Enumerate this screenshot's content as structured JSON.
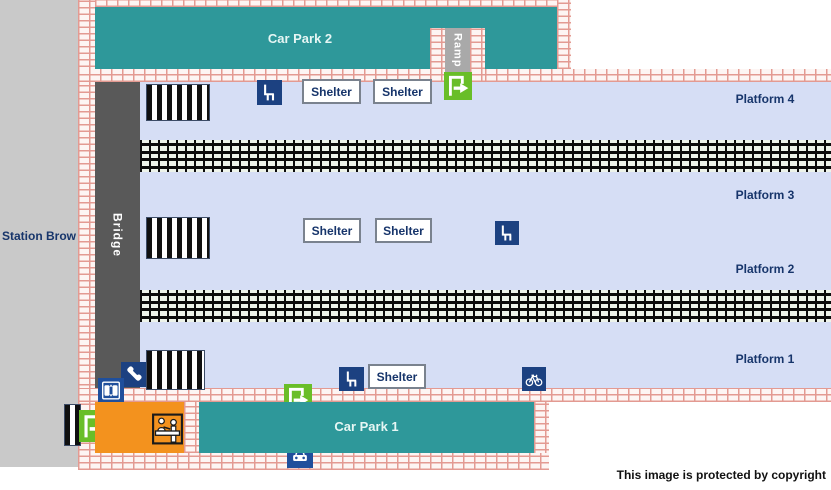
{
  "street": {
    "label": "Station Brow"
  },
  "car_parks": [
    {
      "id": "car-park-2",
      "label": "Car Park 2"
    },
    {
      "id": "car-park-1",
      "label": "Car Park 1"
    }
  ],
  "ramp": {
    "label": "Ramp"
  },
  "bridge": {
    "label": "Bridge"
  },
  "platforms": [
    {
      "label": "Platform 4"
    },
    {
      "label": "Platform 3"
    },
    {
      "label": "Platform 2"
    },
    {
      "label": "Platform 1"
    }
  ],
  "shelters": [
    {
      "location": "platform-4-west",
      "label": "Shelter"
    },
    {
      "location": "platform-4-east",
      "label": "Shelter"
    },
    {
      "location": "island-west",
      "label": "Shelter"
    },
    {
      "location": "island-east",
      "label": "Shelter"
    },
    {
      "location": "platform-1",
      "label": "Shelter"
    }
  ],
  "icons": [
    {
      "name": "seat-icon",
      "meaning": "seating",
      "locations": [
        "platform-4",
        "island-platform",
        "platform-1"
      ]
    },
    {
      "name": "exit-icon",
      "meaning": "entrance/exit",
      "locations": [
        "ramp",
        "car-park-1",
        "street-south-west"
      ]
    },
    {
      "name": "phone-icon",
      "meaning": "telephone"
    },
    {
      "name": "lift-icon",
      "meaning": "lift/doors"
    },
    {
      "name": "bicycle-icon",
      "meaning": "cycle storage"
    },
    {
      "name": "taxi-icon",
      "meaning": "taxi rank"
    },
    {
      "name": "ticket-office-icon",
      "meaning": "ticket office"
    }
  ],
  "colors": {
    "car_park_teal": "#2e989a",
    "platform_lavender": "#d6def5",
    "bridge_gray": "#595959",
    "ramp_gray": "#a9a9a9",
    "brick_pink": "#e39a92",
    "icon_navy": "#1c4181",
    "icon_blue": "#1f4f9c",
    "exit_green": "#69be28",
    "ticket_office_orange": "#f3921e",
    "label_navy": "#17356b",
    "street_gray": "#c9c9c9"
  },
  "footer": {
    "copyright": "This image is protected by copyright"
  }
}
